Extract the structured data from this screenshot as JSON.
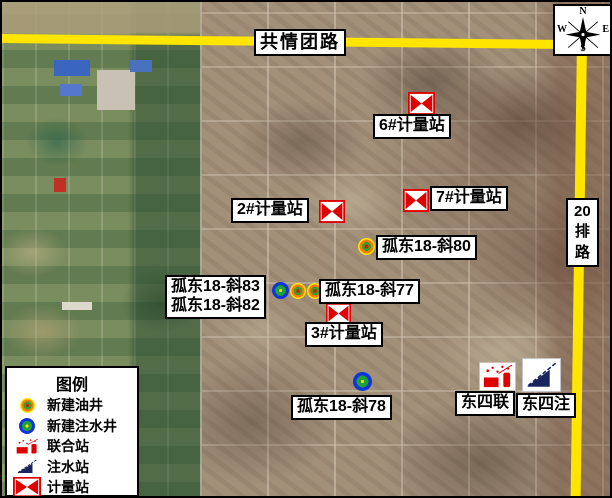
{
  "roads": {
    "color": "#ffe500",
    "horizontal_road_label": "共情团路",
    "vertical_road_label": "20 排路"
  },
  "compass": {
    "north": "N",
    "south": "S",
    "east": "E",
    "west": "W"
  },
  "markers": [
    {
      "name": "metering-station-6-icon",
      "type": "metering-station",
      "x": 406,
      "y": 90,
      "w": 27,
      "h": 23
    },
    {
      "name": "metering-station-2-icon",
      "type": "metering-station",
      "x": 317,
      "y": 198,
      "w": 26,
      "h": 23
    },
    {
      "name": "metering-station-7-icon",
      "type": "metering-station",
      "x": 401,
      "y": 187,
      "w": 26,
      "h": 23
    },
    {
      "name": "metering-station-3-icon",
      "type": "metering-station",
      "x": 324,
      "y": 301,
      "w": 25,
      "h": 21
    },
    {
      "name": "oil-well-gudong18-x80-icon",
      "type": "oil-well",
      "x": 356,
      "y": 236,
      "w": 17,
      "h": 17
    },
    {
      "name": "injection-well-cluster-icon",
      "type": "injection-well",
      "x": 270,
      "y": 280,
      "w": 17,
      "h": 17
    },
    {
      "name": "oil-well-cluster-a-icon",
      "type": "oil-well",
      "x": 288,
      "y": 281,
      "w": 16,
      "h": 16
    },
    {
      "name": "oil-well-cluster-b-icon",
      "type": "oil-well",
      "x": 305,
      "y": 281,
      "w": 16,
      "h": 16
    },
    {
      "name": "injection-well-gudong18-x78-icon",
      "type": "injection-well",
      "x": 351,
      "y": 370,
      "w": 19,
      "h": 19
    },
    {
      "name": "union-station-dongsilian-icon",
      "type": "union-station",
      "x": 477,
      "y": 360,
      "w": 37,
      "h": 29
    },
    {
      "name": "injection-station-dongsizhu-icon",
      "type": "injection-station",
      "x": 520,
      "y": 356,
      "w": 39,
      "h": 34
    }
  ],
  "labels": [
    {
      "name": "road-label-gongqingtuan",
      "lines": [
        "共情团路"
      ],
      "x": 252,
      "y": 27,
      "size": 18,
      "spacing": 2
    },
    {
      "name": "label-metering-station-6",
      "lines": [
        "6#计量站"
      ],
      "x": 371,
      "y": 112,
      "size": 16
    },
    {
      "name": "label-metering-station-2",
      "lines": [
        "2#计量站"
      ],
      "x": 229,
      "y": 196,
      "size": 16
    },
    {
      "name": "label-metering-station-7",
      "lines": [
        "7#计量站"
      ],
      "x": 428,
      "y": 184,
      "size": 16
    },
    {
      "name": "label-oil-well-gudong18-x80",
      "lines": [
        "孤东18-斜80"
      ],
      "x": 374,
      "y": 233,
      "size": 16
    },
    {
      "name": "label-wells-gudong18-x83-x82",
      "lines": [
        "孤东18-斜83",
        "孤东18-斜82"
      ],
      "x": 163,
      "y": 273,
      "size": 16
    },
    {
      "name": "label-oil-well-gudong18-x77",
      "lines": [
        "孤东18-斜77"
      ],
      "x": 317,
      "y": 277,
      "size": 16
    },
    {
      "name": "label-metering-station-3",
      "lines": [
        "3#计量站"
      ],
      "x": 303,
      "y": 320,
      "size": 16
    },
    {
      "name": "label-injection-well-gudong18-x78",
      "lines": [
        "孤东18-斜78"
      ],
      "x": 289,
      "y": 393,
      "size": 16
    },
    {
      "name": "label-dongsilian",
      "lines": [
        "东四联"
      ],
      "x": 453,
      "y": 389,
      "size": 16
    },
    {
      "name": "label-dongsizhu",
      "lines": [
        "东四注"
      ],
      "x": 514,
      "y": 391,
      "size": 16
    },
    {
      "name": "road-label-20pai",
      "lines": [
        "20",
        "排",
        "路"
      ],
      "x": 564,
      "y": 196,
      "size": 15,
      "vertical": true
    }
  ],
  "legend": {
    "title": "图例",
    "items": [
      {
        "icon": "oil-well",
        "label": "新建油井"
      },
      {
        "icon": "injection-well",
        "label": "新建注水井"
      },
      {
        "icon": "union-station",
        "label": "联合站"
      },
      {
        "icon": "injection-station",
        "label": "注水站"
      },
      {
        "icon": "metering-station",
        "label": "计量站"
      }
    ]
  }
}
